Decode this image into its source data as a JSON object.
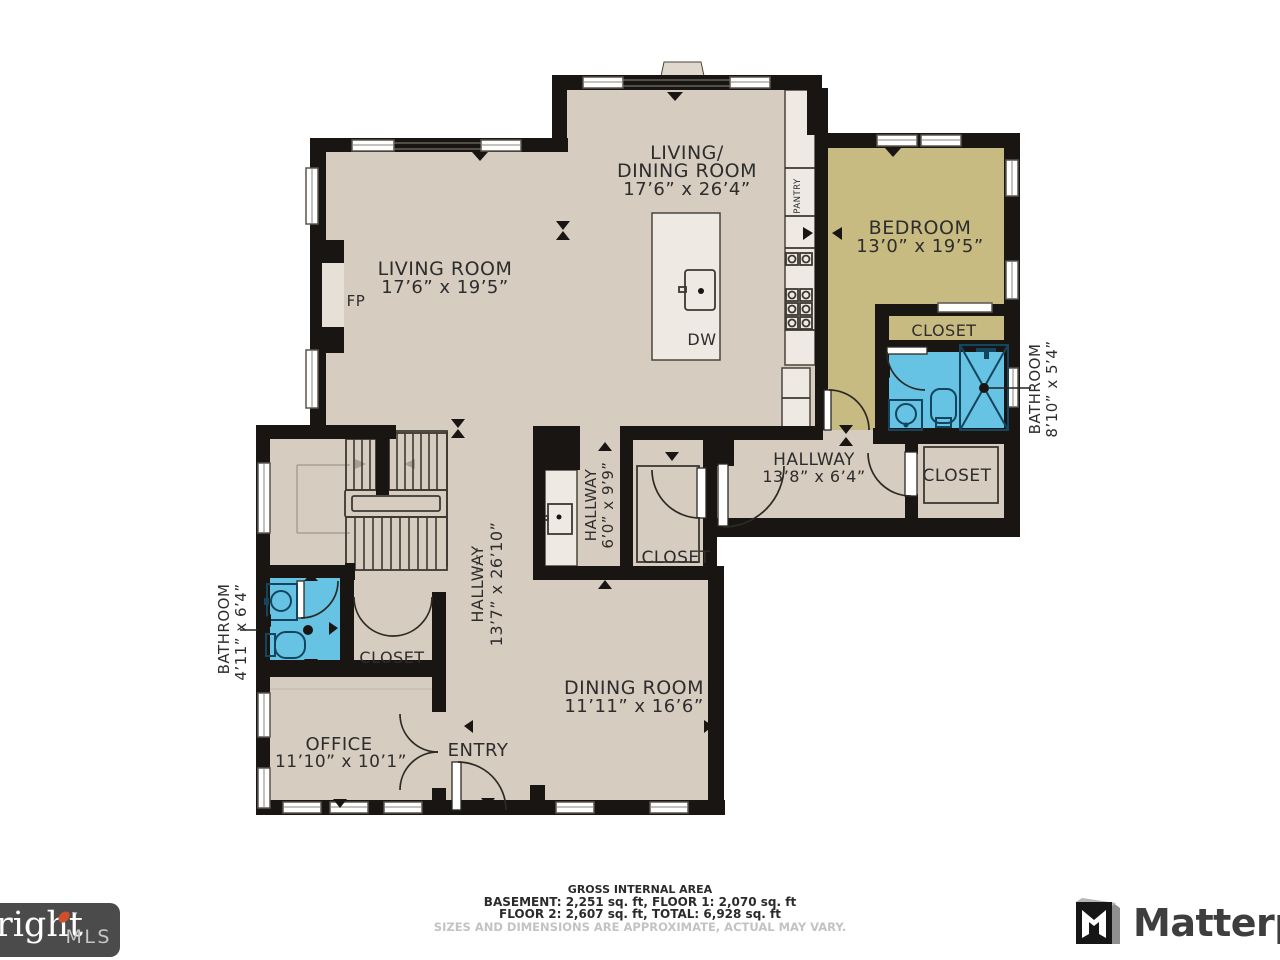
{
  "colors": {
    "floor": "#d7ccc0",
    "bedroom": "#c8bb82",
    "bathroom": "#66c3e4",
    "wall": "#181512",
    "counter": "#eee9e2"
  },
  "plan": {
    "rooms": {
      "living_dining": {
        "name1": "LIVING/",
        "name2": "DINING ROOM",
        "dims": "17’6” x 26’4”"
      },
      "living": {
        "name": "LIVING ROOM",
        "dims": "17’6” x 19’5”"
      },
      "bedroom": {
        "name": "BEDROOM",
        "dims": "13’0” x 19’5”"
      },
      "dining": {
        "name": "DINING ROOM",
        "dims": "11’11” x 16’6”"
      },
      "office": {
        "name": "OFFICE",
        "dims": "11’10” x 10’1”"
      },
      "entry": {
        "name": "ENTRY"
      },
      "hallway_right": {
        "name": "HALLWAY",
        "dims": "13’8” x 6’4”"
      },
      "hallway_mid": {
        "name": "HALLWAY",
        "dims": "6’0” x 9’9”"
      },
      "hallway_main": {
        "name": "HALLWAY",
        "dims": "13’7” x 26’10”"
      },
      "bathroom_left": {
        "name": "BATHROOM",
        "dims": "4’11” x 6’4”"
      },
      "bathroom_right": {
        "name": "BATHROOM",
        "dims": "8’10” x 5’4”"
      },
      "closet": {
        "name": "CLOSET"
      }
    },
    "fixtures": {
      "fireplace": "FP",
      "dishwasher": "DW",
      "pantry": "PANTRY"
    }
  },
  "footer": {
    "line1": "GROSS INTERNAL AREA",
    "line2": "BASEMENT: 2,251 sq. ft, FLOOR 1: 2,070 sq. ft",
    "line3": "FLOOR 2: 2,607 sq. ft, TOTAL: 6,928 sq. ft",
    "line4": "SIZES AND DIMENSIONS ARE APPROXIMATE, ACTUAL MAY VARY."
  },
  "branding": {
    "mls_name": "right",
    "mls_tm": "™",
    "mls_suffix": "MLS",
    "matterport": "Matterport"
  }
}
